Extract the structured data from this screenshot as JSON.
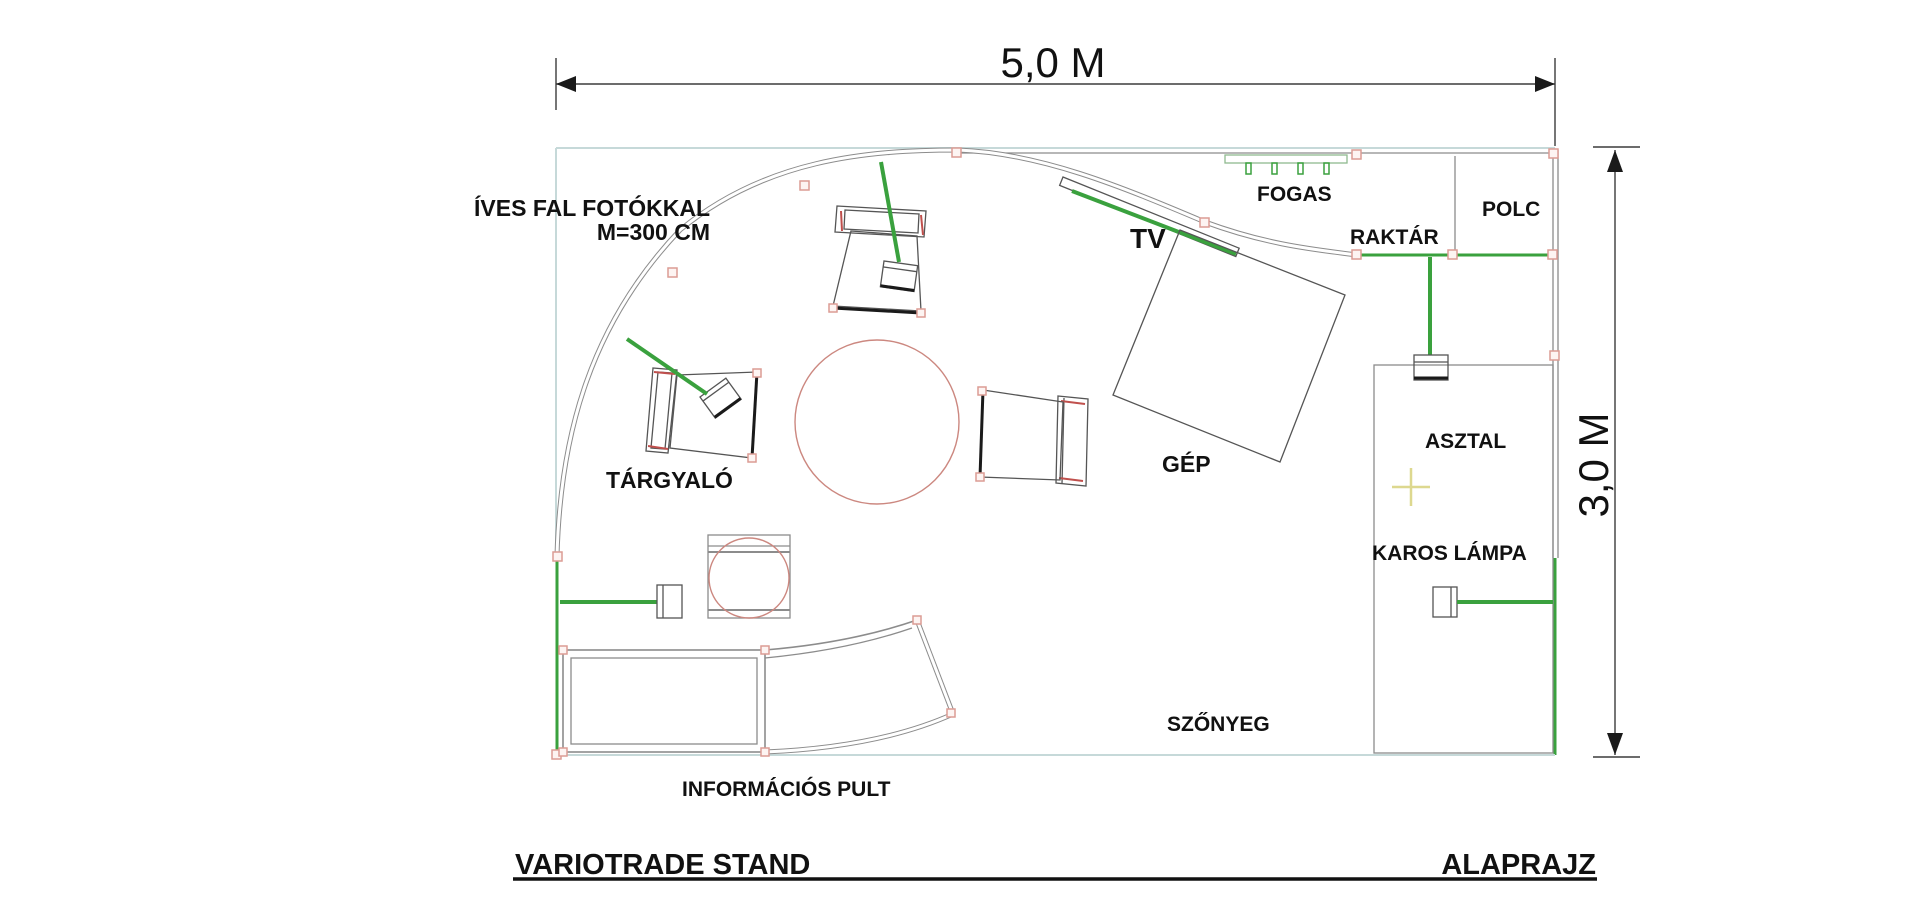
{
  "title_block": {
    "project": "VARIOTRADE STAND",
    "drawing": "ALAPRAJZ"
  },
  "dimensions": {
    "width_label": "5,0 M",
    "height_label": "3,0 M"
  },
  "wall_note": {
    "line1": "ÍVES FAL FOTÓKKAL",
    "line2": "M=300 CM"
  },
  "labels": {
    "fogas": "FOGAS",
    "raktar": "RAKTÁR",
    "polc": "POLC",
    "tv": "TV",
    "gep": "GÉP",
    "targyalo": "TÁRGYALÓ",
    "asztal": "ASZTAL",
    "karos_lampa": "KAROS LÁMPA",
    "szonyeg": "SZŐNYEG",
    "informacios_pult": "INFORMÁCIÓS PULT"
  },
  "colors": {
    "wall_green": "#3aa13e",
    "boundary_teal": "#c6d9d9",
    "line_gray": "#8c8c8c",
    "marker_pink": "#dc9c94",
    "table_red": "#cc8880",
    "cross_yellow": "#ddd88f",
    "accent_red": "#c0504d",
    "ink": "#111111"
  }
}
